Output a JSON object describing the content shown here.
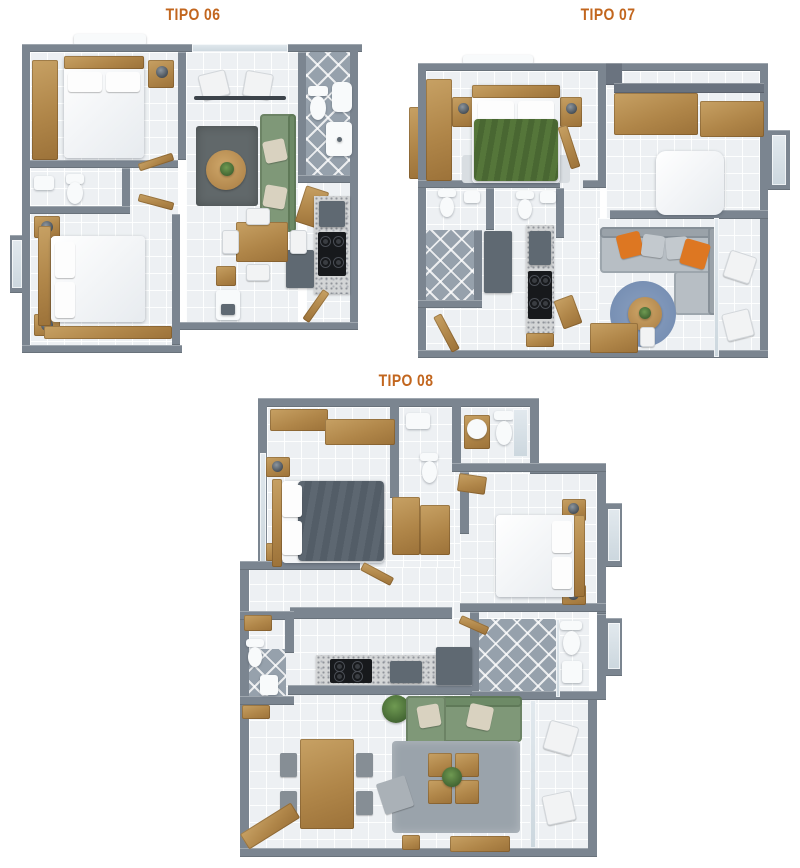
{
  "page": {
    "background": "#ffffff"
  },
  "plans": [
    {
      "id": "tipo-06",
      "title": "TIPO 06"
    },
    {
      "id": "tipo-07",
      "title": "TIPO 07"
    },
    {
      "id": "tipo-08",
      "title": "TIPO 08"
    }
  ],
  "palette": {
    "title_orange": "#c2661e",
    "wall_gray": "#7b8590",
    "floor_light": "#edf0f3",
    "bath_tile": "#96a1ac",
    "wood": "#b08649",
    "sofa_green": "#7f9878",
    "bed_green": "#4e6b33",
    "bed_dark": "#59636d",
    "sofa_gray": "#b7bec4",
    "pillow_orange": "#dd7722",
    "rug_blue": "#7890b4",
    "rug_gray": "#9aa3ab",
    "counter_granite": "#d3d5d6",
    "appliance_black": "#17191c",
    "fixture_white": "#f8fafb"
  }
}
